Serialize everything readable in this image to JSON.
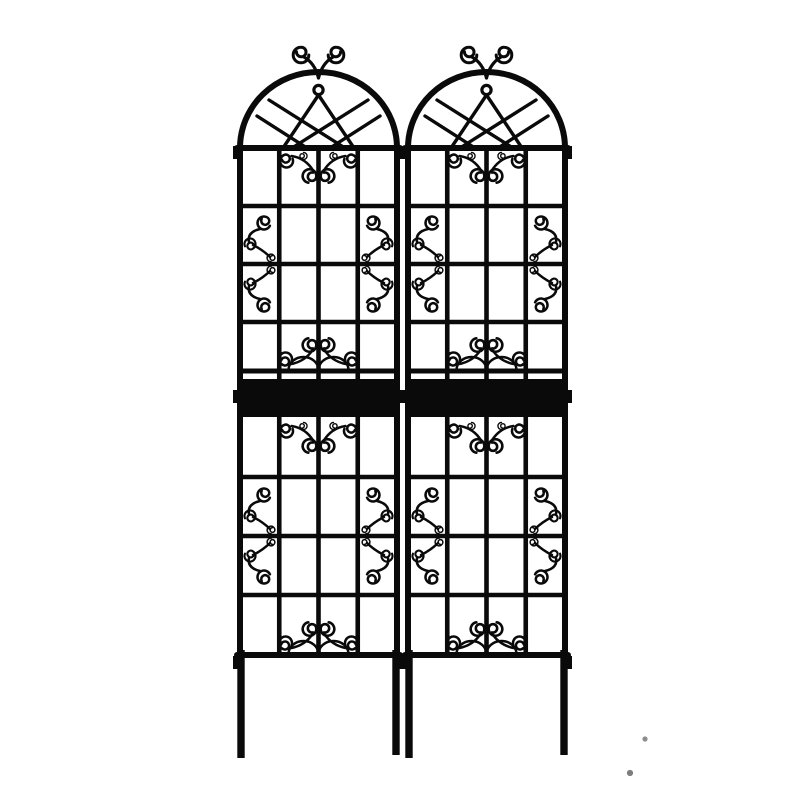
{
  "page": {
    "background_color": "#ffffff"
  },
  "product_image": {
    "description": "Two identical black metal arched garden trellis panels with gothic arch tracery, scrollwork ornaments, square grid lattice, top scroll finials and ground stake legs",
    "ink_color": "#0a0a0a",
    "panel_count": 2
  },
  "artifacts": {
    "specks": [
      {
        "x": 645,
        "y": 739,
        "r": 2.6,
        "color": "#8d8d8d"
      },
      {
        "x": 630,
        "y": 773,
        "r": 3.1,
        "color": "#7e7e7e"
      }
    ]
  }
}
